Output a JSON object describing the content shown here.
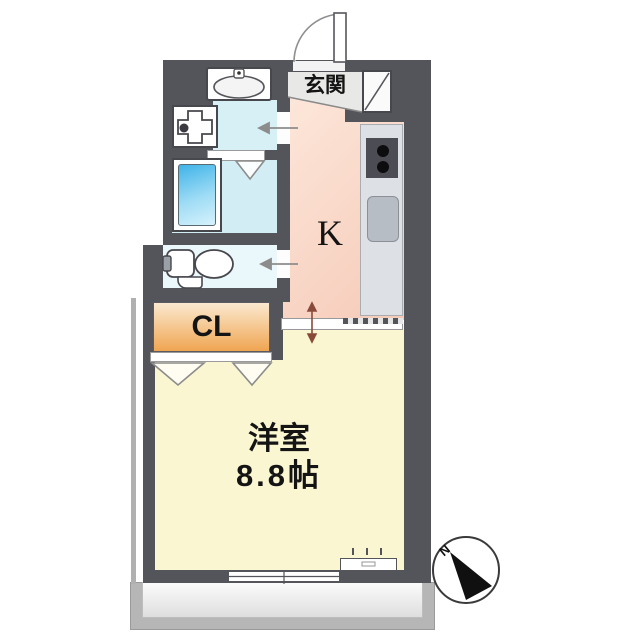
{
  "plan": {
    "entrance_label": "玄関",
    "kitchen_label": "K",
    "closet_label": "CL",
    "room_label": "洋室",
    "room_size_label": "8.8帖",
    "compass_north_label": "N"
  },
  "colors": {
    "wall": "#54545b",
    "kitchen_floor_light": "#fdeade",
    "kitchen_floor_dark": "#f6cab8",
    "western_room_floor": "#faf6d2",
    "washroom_floor": "#d6f0f6",
    "bathroom_floor": "#d2eef4",
    "toilet_floor": "#eaf8fc",
    "closet_gradient_top": "#fbe9cf",
    "closet_gradient_bottom": "#efa551",
    "bathtub_blue": "#3fb3e8",
    "counter_gray": "#dde1e5",
    "sink_gray": "#b6bdc4",
    "genkan_gray": "#e8e8e6",
    "balcony_gray": "#b6b6b6"
  },
  "fixtures": {
    "entrance_door": "hinged-door-arc",
    "shoe_cabinet": "shoe-cabinet",
    "stove": "two-burner-stove",
    "kitchen_sink": "kitchen-sink",
    "vanity_basin": "vanity-basin",
    "washer_pan": "washing-machine-pan",
    "bathtub": "bathtub",
    "toilet": "toilet",
    "closet_doors": "double-outswing-doors",
    "sliding_door": "sliding-door",
    "window": "sliding-window",
    "air_conditioner": "ac-unit-box",
    "balcony": "balcony",
    "compass": "north-compass"
  }
}
